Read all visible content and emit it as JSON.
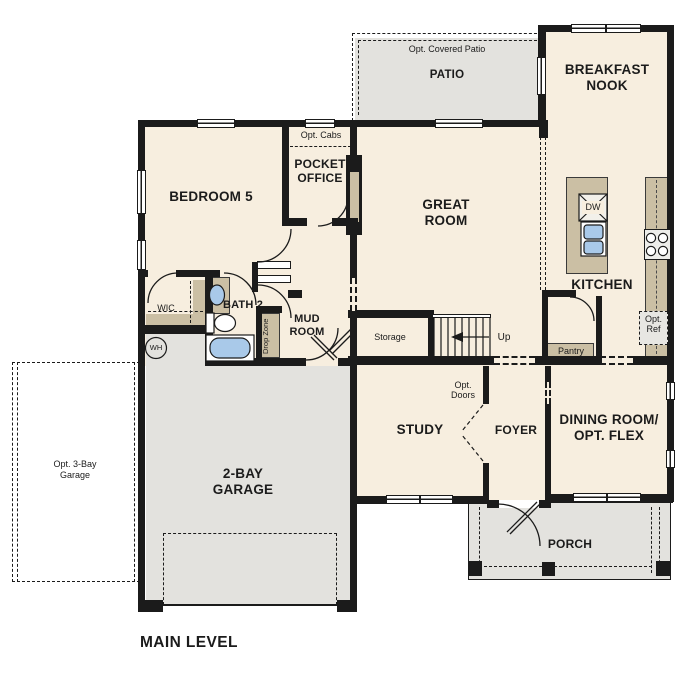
{
  "page": {
    "plan_title": "MAIN LEVEL"
  },
  "rooms": {
    "bedroom5": "BEDROOM 5",
    "wic": "WIC",
    "bath2": "BATH 2",
    "pocket_office": "POCKET OFFICE",
    "great_room": "GREAT ROOM",
    "breakfast_nook": "BREAKFAST NOOK",
    "kitchen": "KITCHEN",
    "mud_room": "MUD ROOM",
    "storage": "Storage",
    "study": "STUDY",
    "foyer": "FOYER",
    "dining_flex": "DINING ROOM/ OPT. FLEX",
    "garage": "2-BAY GARAGE",
    "patio": "PATIO",
    "porch": "PORCH"
  },
  "annotations": {
    "opt_covered_patio": "Opt. Covered Patio",
    "opt_cabs": "Opt. Cabs",
    "opt_doors": "Opt. Doors",
    "opt_ref": "Opt. Ref",
    "opt_3bay_garage": "Opt. 3-Bay Garage",
    "pantry": "Pantry",
    "drop_zone": "Drop Zone",
    "stairs_up": "Up",
    "water_heater": "WH",
    "dishwasher": "DW"
  },
  "colors": {
    "floor": "#f7eedf",
    "outdoor_gray": "#e3e2de",
    "counter_tan": "#cbbfa4",
    "water_blue": "#a9c9e9",
    "wall": "#1b1b1b"
  }
}
